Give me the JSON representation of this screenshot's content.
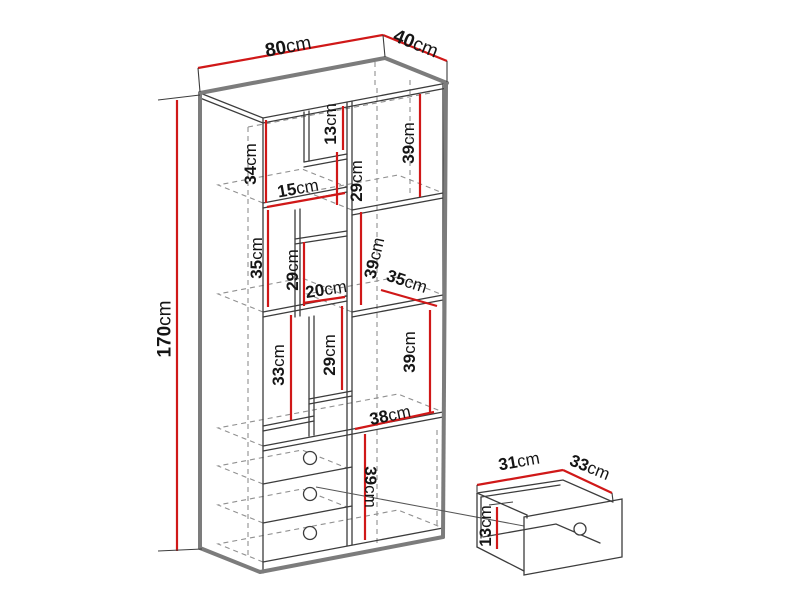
{
  "diagram_title": "cabinet-dimension-diagram",
  "cabinet": {
    "overall": {
      "width": "80cm",
      "depth": "40cm",
      "height": "170cm"
    },
    "compartments": {
      "top_left_height": "34cm",
      "top_center_height": "13cm",
      "upper_center_height": "29cm",
      "top_right_height": "39cm",
      "shelf_width_15": "15cm",
      "mid_left_height": "35cm",
      "mid_center_height": "29cm",
      "shelf_width_20": "20cm",
      "mid_right_height": "39cm",
      "shelf_depth_35": "35cm",
      "lower_left_height": "33cm",
      "lower_center_height": "29cm",
      "lower_right_height": "39cm",
      "bottom_right_width": "38cm",
      "bottom_right_height": "39cm"
    }
  },
  "drawer_detail": {
    "width": "31cm",
    "depth": "33cm",
    "height": "13cm"
  },
  "colors": {
    "dimension_red": "#d01818",
    "outline_gray": "#7c7c7c",
    "line_dark": "#3c3c3c",
    "hidden_gray": "#909090",
    "background": "#ffffff"
  }
}
